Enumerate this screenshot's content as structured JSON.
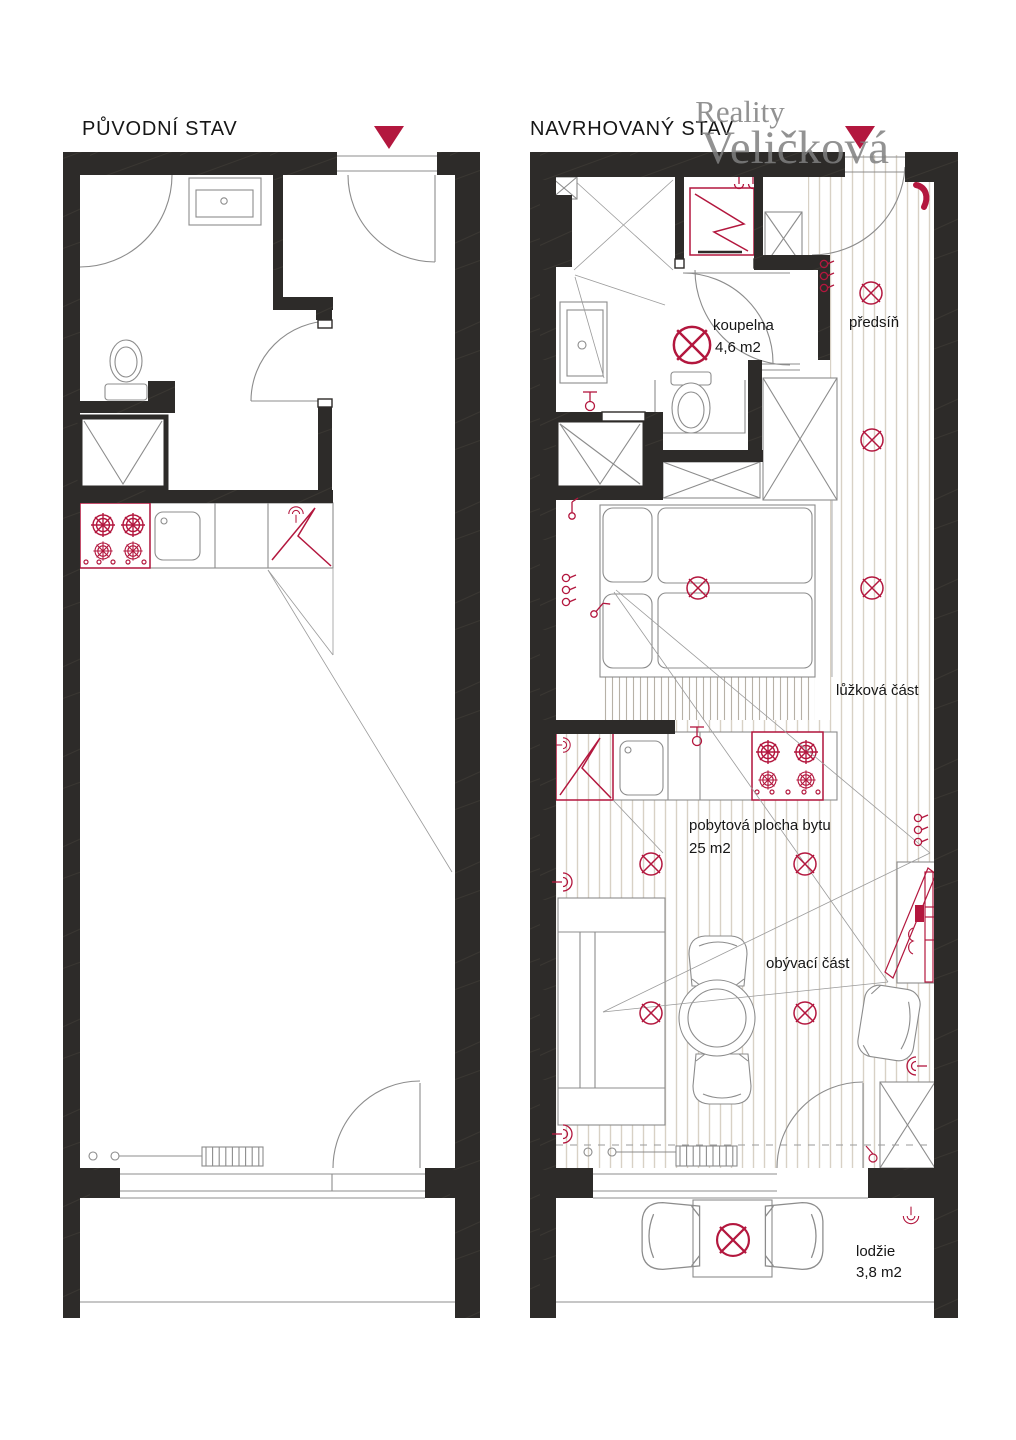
{
  "watermark": {
    "line1": "Reality",
    "line2": "Veličková"
  },
  "left_plan": {
    "title": "PŮVODNÍ STAV"
  },
  "right_plan": {
    "title": "NAVRHOVANÝ STAV",
    "rooms": {
      "bathroom": {
        "name": "koupelna",
        "area": "4,6 m2"
      },
      "hallway": {
        "name": "předsíň"
      },
      "bed_area": {
        "name": "lůžková část"
      },
      "living_space": {
        "name": "pobytová plocha bytu",
        "area": "25 m2"
      },
      "living_area": {
        "name": "obývací část"
      },
      "loggia": {
        "name": "lodžie",
        "area": "3,8 m2"
      }
    }
  },
  "colors": {
    "wall": "#2d2b29",
    "accent_red": "#b3173e",
    "floor_stripe": "#d8d1c5",
    "line_gray": "#8c8c8c",
    "watermark_gray": "#7f7f7f"
  }
}
